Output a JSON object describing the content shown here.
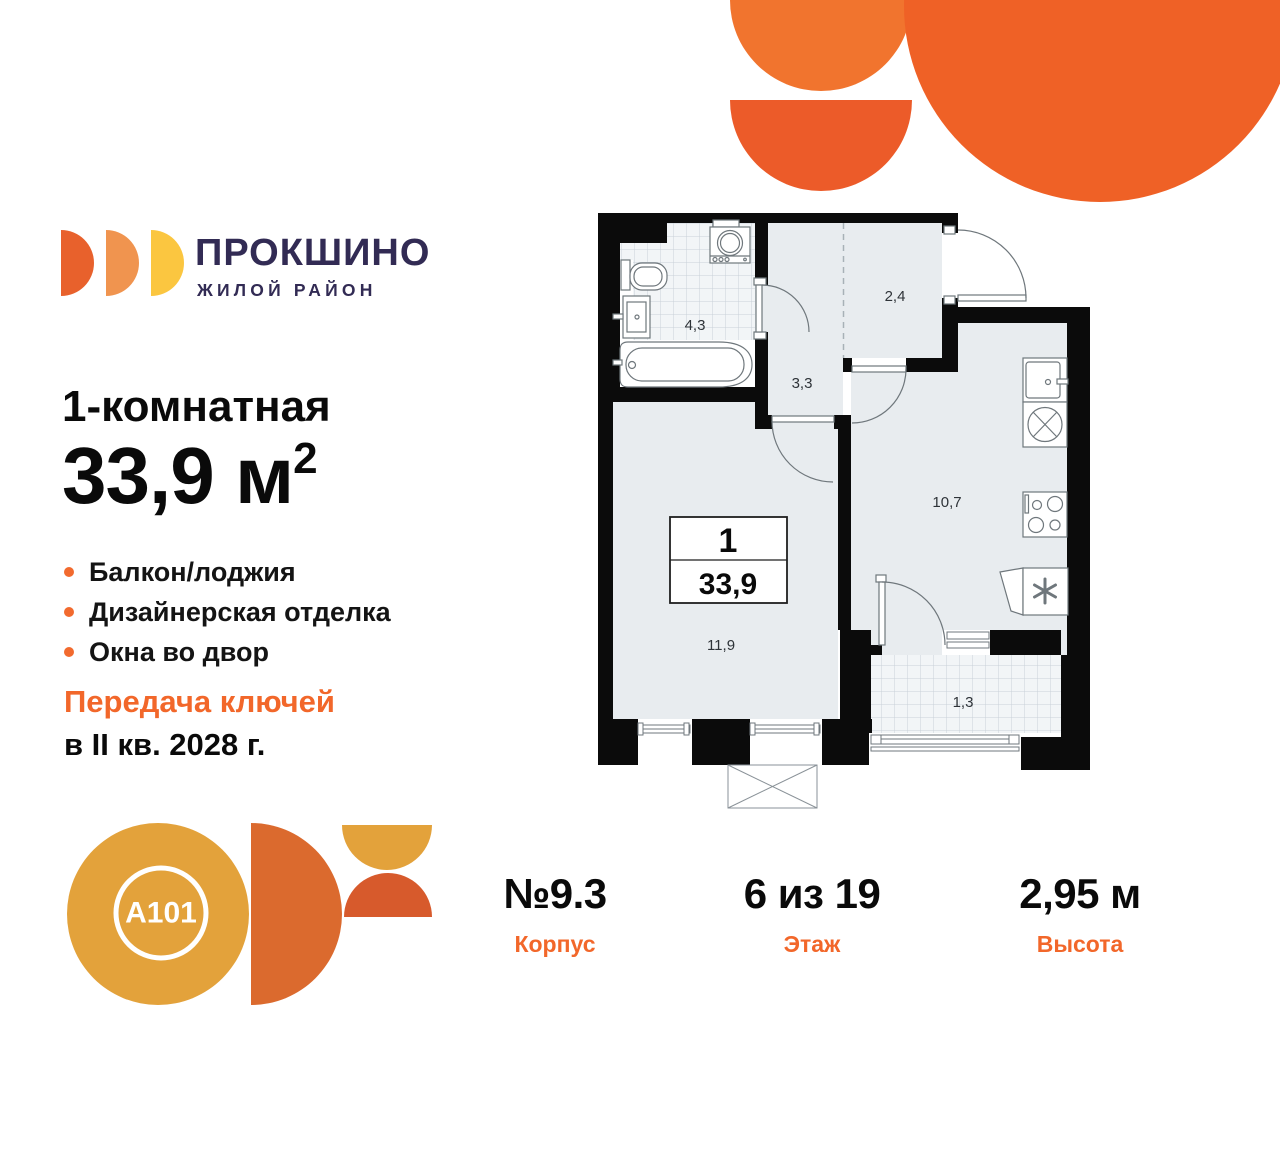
{
  "brand": {
    "name": "ПРОКШИНО",
    "tagline": "ЖИЛОЙ РАЙОН"
  },
  "listing": {
    "type": "1-комнатная",
    "area": "33,9",
    "area_unit": "м",
    "area_sup": "2",
    "features": [
      "Балкон/лоджия",
      "Дизайнерская отделка",
      "Окна во двор"
    ],
    "keys_title": "Передача ключей",
    "keys_date": "в II кв. 2028 г."
  },
  "developer": {
    "logo": "A101"
  },
  "floorplan": {
    "info_box": {
      "rooms": "1",
      "area": "33,9"
    },
    "rooms": {
      "bathroom": "4,3",
      "entry": "2,4",
      "hall": "3,3",
      "kitchen": "10,7",
      "living": "11,9",
      "balcony": "1,3"
    }
  },
  "summary": [
    {
      "value": "№9.3",
      "label": "Корпус"
    },
    {
      "value": "6 из 19",
      "label": "Этаж"
    },
    {
      "value": "2,95 м",
      "label": "Высота"
    }
  ],
  "colors": {
    "accent_orange": "#F2672A",
    "brand_navy": "#322B54",
    "logo_orange_1": "#E8612C",
    "logo_orange_2": "#F0944F",
    "logo_yellow": "#FBC640",
    "a101_amber": "#E3A23B",
    "a101_burnt": "#DB6A2E",
    "decor_orange": "#EF6126",
    "plan_floor": "#E8ECEF",
    "plan_wall": "#0B0B0B"
  }
}
